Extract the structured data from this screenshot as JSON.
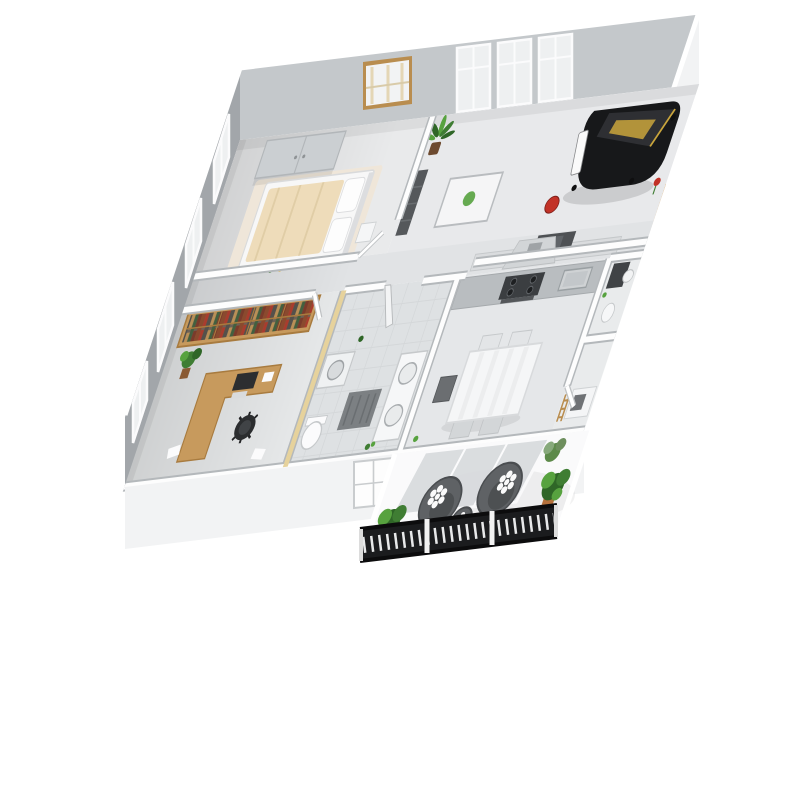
{
  "meta": {
    "type": "3d-isometric-apartment-floorplan-render",
    "background": "#ffffff"
  },
  "palette": {
    "outer_wall": "#f2f3f4",
    "left_wall": "#a2a6aa",
    "back_wall": "#c4c8cb",
    "floor": "#e7e9ea",
    "corridor_floor": "#e1e3e5",
    "tile": "#dee1e3",
    "wood": "#c79a5d",
    "wood_dark": "#a87b3f",
    "piano": "#17181a",
    "piano_gold": "#c9a53c",
    "accent_red": "#c23227",
    "plant_green": "#57a23f",
    "plant_green_dark": "#2f6627",
    "chair_dark": "#5f6265",
    "railing": "#1b1c1e",
    "glass": "#d7dadd",
    "counter": "#b9bdc0",
    "stove": "#3b3e41",
    "orange_panel": "#d98e2f",
    "bed_beige": "#eedcba",
    "rug_beige": "#efe6d9",
    "pot_terracotta": "#b5713c"
  },
  "scene": {
    "view": "dollhouse-cutaway-from-above",
    "rooms": [
      {
        "id": "bedroom",
        "position": "top-left",
        "furniture": [
          "double-wardrobe",
          "double-bed-beige-duvet",
          "white-pillows",
          "nightstand",
          "wood-framed-window",
          "side-wall-windows",
          "floor-flowers"
        ]
      },
      {
        "id": "living-room",
        "position": "top-right",
        "furniture": [
          "black-grand-piano",
          "red-piano-stool",
          "tall-french-windows",
          "palm-plant",
          "glass-coffee-table",
          "dark-shelf-unit",
          "red-flowers",
          "half-wall-counter",
          "microwave",
          "orange-louver-panel"
        ]
      },
      {
        "id": "office",
        "position": "middle-left",
        "furniture": [
          "full-wall-bookshelf",
          "l-shaped-wood-desk",
          "computer-monitor",
          "black-office-chair",
          "potted-plant",
          "side-wall-windows",
          "papers"
        ]
      },
      {
        "id": "bathroom",
        "position": "center",
        "furniture": [
          "washing-machine",
          "toilet",
          "double-sink-vanity",
          "dark-bath-mat",
          "door-ajar",
          "green-bottles"
        ]
      },
      {
        "id": "kitchen",
        "position": "center-right",
        "furniture": [
          "range-hood",
          "gray-counter",
          "gas-cooktop",
          "oven",
          "sink",
          "white-dining-table",
          "chairs",
          "high-chair"
        ]
      },
      {
        "id": "wc",
        "position": "right",
        "furniture": [
          "dark-cabinet",
          "small-sink",
          "toilet"
        ]
      },
      {
        "id": "entrance-hall",
        "position": "bottom-right",
        "furniture": [
          "console-table",
          "gray-storage-box",
          "wood-ladder-shelf"
        ]
      },
      {
        "id": "balcony",
        "position": "bottom",
        "furniture": [
          "round-lounge-chair-left",
          "round-lounge-chair-right",
          "round-side-table",
          "flower-cushions",
          "potted-plant-left",
          "potted-plant-right",
          "potted-plant-corner",
          "wrought-iron-railing",
          "tilted-glass-door"
        ]
      }
    ]
  }
}
